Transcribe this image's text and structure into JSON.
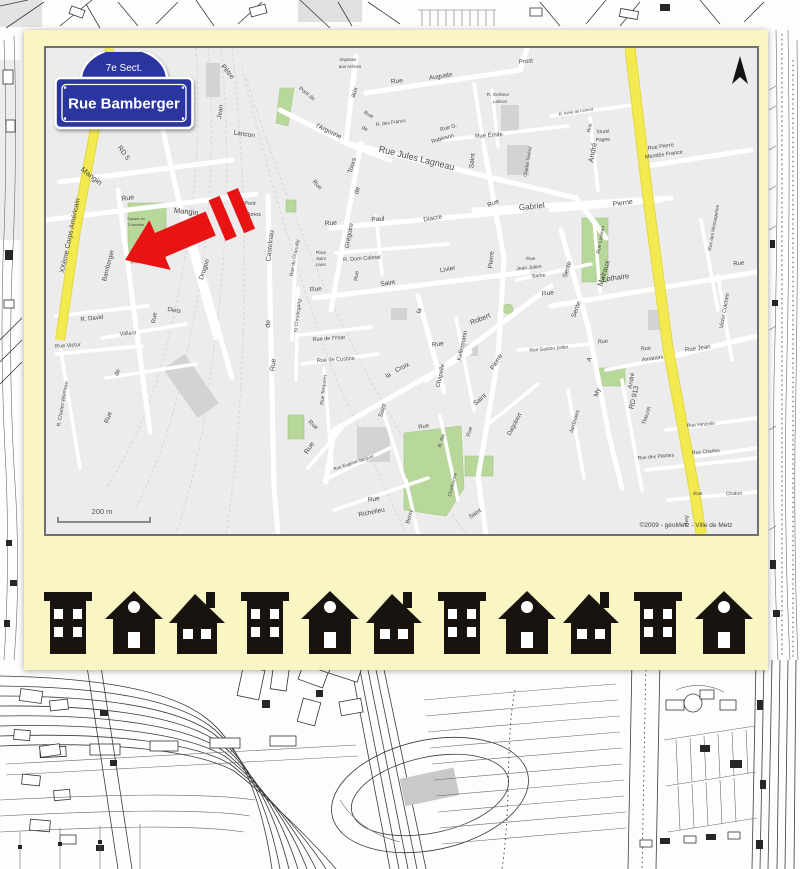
{
  "postcard": {
    "sign": {
      "section": "7e Sect.",
      "street": "Rue Bamberger"
    },
    "map": {
      "scale_label": "200 m",
      "attribution": "©2009 - géoMetz - Ville de Metz",
      "labels": [
        [
          "Pètre",
          180,
          25,
          50,
          7
        ],
        [
          "Jean",
          176,
          64,
          -82,
          6.5
        ],
        [
          "Lancon",
          198,
          88,
          8,
          6.5
        ],
        [
          "Mangin",
          44,
          130,
          38,
          7.5
        ],
        [
          "RD 5",
          76,
          106,
          55,
          7
        ],
        [
          "XXème Corps Américain",
          26,
          188,
          -78,
          7
        ],
        [
          "Rue",
          82,
          152,
          -8,
          7
        ],
        [
          "Mangin",
          140,
          166,
          6,
          7.5
        ],
        [
          "Pont",
          204,
          157,
          0,
          5.5
        ],
        [
          "Amos",
          208,
          168,
          0,
          5.5
        ],
        [
          "Drogon",
          110,
          52,
          -80,
          6.5
        ],
        [
          "Drogon",
          160,
          222,
          -72,
          6.5
        ],
        [
          "Bamberger",
          64,
          218,
          -75,
          6.5
        ],
        [
          "Aubrée",
          94,
          213,
          -15,
          5
        ],
        [
          "R. David",
          46,
          272,
          -6,
          6
        ],
        [
          "Dietz",
          128,
          264,
          10,
          6
        ],
        [
          "Vallant",
          82,
          287,
          -5,
          5.5
        ],
        [
          "Rue",
          110,
          270,
          -82,
          6
        ],
        [
          "Rue Victor",
          22,
          299,
          -4,
          5.5
        ],
        [
          "R. Charles Woirhaye",
          18,
          356,
          -80,
          5
        ],
        [
          "de",
          73,
          325,
          -70,
          6
        ],
        [
          "Rue",
          64,
          370,
          -70,
          6.5
        ],
        [
          "Castelnau",
          226,
          198,
          -84,
          7
        ],
        [
          "de",
          224,
          276,
          -84,
          7
        ],
        [
          "Rue",
          229,
          317,
          -84,
          7
        ],
        [
          "Pont de",
          260,
          47,
          38,
          5.5
        ],
        [
          "l'Argonne",
          282,
          85,
          26,
          6.5
        ],
        [
          "aux",
          310,
          45,
          -72,
          6.5
        ],
        [
          "Impasse",
          302,
          13,
          0,
          4.5
        ],
        [
          "aux Arènes",
          304,
          20,
          0,
          4.5
        ],
        [
          "Rue",
          351,
          35,
          -6,
          6.5
        ],
        [
          "Auguste",
          395,
          30,
          -9,
          6.5
        ],
        [
          "Prost",
          480,
          15,
          -5,
          6
        ],
        [
          "R. Gerbeur",
          452,
          48,
          0,
          4.5
        ],
        [
          "Lebrun",
          454,
          55,
          0,
          4.5
        ],
        [
          "Rue G.",
          403,
          81,
          -16,
          5.5
        ],
        [
          "Robinson",
          397,
          92,
          -16,
          5.5
        ],
        [
          "Rue Émile",
          443,
          89,
          -4,
          6
        ],
        [
          "R. des Francs",
          345,
          76,
          -8,
          4.8
        ],
        [
          "Rue",
          322,
          68,
          28,
          5.5
        ],
        [
          "de",
          318,
          82,
          28,
          5.5
        ],
        [
          "Rue Jules Lagneau",
          370,
          113,
          14,
          9
        ],
        [
          "Saint",
          428,
          113,
          -84,
          6.5
        ],
        [
          "Rue",
          448,
          157,
          -24,
          6.5
        ],
        [
          "Gabriel",
          486,
          161,
          -5,
          8
        ],
        [
          "Charles Sadoul",
          483,
          114,
          -80,
          4.5
        ],
        [
          "Tours",
          308,
          118,
          -73,
          6.5
        ],
        [
          "de",
          313,
          143,
          -73,
          6.5
        ],
        [
          "Grégoire",
          305,
          188,
          -80,
          6.5
        ],
        [
          "Rue",
          285,
          177,
          -4,
          6.5
        ],
        [
          "Paul",
          332,
          173,
          -4,
          6.5
        ],
        [
          "Diacre",
          387,
          172,
          -10,
          6.5
        ],
        [
          "Pierre",
          447,
          212,
          -84,
          6.5
        ],
        [
          "Rue",
          270,
          138,
          45,
          6
        ],
        [
          "Rue du Graouilly",
          250,
          210,
          -80,
          5
        ],
        [
          "Place",
          275,
          206,
          0,
          4.2
        ],
        [
          "Saint",
          275,
          212,
          0,
          4.2
        ],
        [
          "Livier",
          275,
          218,
          0,
          4.2
        ],
        [
          "R. Dom Calmat",
          316,
          212,
          -4,
          5.5
        ],
        [
          "Rue",
          312,
          228,
          -84,
          5.5
        ],
        [
          "Rue",
          270,
          243,
          -5,
          6.5
        ],
        [
          "Saint",
          342,
          237,
          -8,
          6.5
        ],
        [
          "Livier",
          402,
          223,
          -10,
          6.5
        ],
        [
          "St Chrodegang",
          253,
          268,
          -84,
          5
        ],
        [
          "Rue de l'Ysar",
          283,
          292,
          -4,
          5.5
        ],
        [
          "Rue de Custine",
          290,
          313,
          -4,
          5.5
        ],
        [
          "Rue Terquem",
          279,
          342,
          -84,
          5
        ],
        [
          "la",
          375,
          263,
          -78,
          6.5
        ],
        [
          "Rue",
          392,
          298,
          -8,
          6.5
        ],
        [
          "Chapelle",
          396,
          328,
          -78,
          6
        ],
        [
          "la",
          343,
          329,
          -26,
          6.5
        ],
        [
          "Croix",
          357,
          321,
          -26,
          6.5
        ],
        [
          "Kellermann",
          418,
          298,
          -78,
          6
        ],
        [
          "Robert",
          435,
          273,
          -22,
          7
        ],
        [
          "Pierre",
          452,
          315,
          -58,
          6.5
        ],
        [
          "Saint",
          435,
          353,
          -40,
          6.5
        ],
        [
          "Rue",
          485,
          212,
          -5,
          5
        ],
        [
          "Jean Julien",
          483,
          221,
          -5,
          5
        ],
        [
          "Barbe",
          493,
          229,
          -5,
          5
        ],
        [
          "Sente",
          523,
          222,
          -73,
          6.5
        ],
        [
          "Sente",
          532,
          262,
          -70,
          6.5
        ],
        [
          "A",
          545,
          312,
          -68,
          6.5
        ],
        [
          "My",
          553,
          345,
          -73,
          6.5
        ],
        [
          "Lothaire",
          570,
          232,
          -8,
          7.5
        ],
        [
          "Rue",
          502,
          247,
          -5,
          6.5
        ],
        [
          "Malraux",
          560,
          226,
          -73,
          7.5
        ],
        [
          "RD 913",
          590,
          350,
          -77,
          7
        ],
        [
          "André",
          549,
          105,
          -80,
          7.5
        ],
        [
          "Victor Colchen",
          680,
          263,
          -80,
          5.5
        ],
        [
          "Rue",
          693,
          217,
          -5,
          6
        ],
        [
          "Rue Jean",
          652,
          302,
          -8,
          6
        ],
        [
          "Rue",
          600,
          302,
          -5,
          5.5
        ],
        [
          "Amataire",
          607,
          312,
          -8,
          5.5
        ],
        [
          "André",
          587,
          333,
          -80,
          6
        ],
        [
          "Theurin",
          602,
          368,
          -73,
          5.5
        ],
        [
          "Rue Hinzelin",
          655,
          378,
          -5,
          5
        ],
        [
          "Rue Gaston Zeller",
          503,
          302,
          -5,
          4.8
        ],
        [
          "Jardiniers",
          530,
          374,
          -73,
          5.5
        ],
        [
          "Rue",
          557,
          295,
          -5,
          5.5
        ],
        [
          "Rue des Plantes",
          610,
          410,
          -5,
          5
        ],
        [
          "Rue Charles",
          660,
          405,
          -5,
          5
        ],
        [
          "Rue",
          652,
          447,
          -3,
          5
        ],
        [
          "Chabot",
          688,
          447,
          -3,
          5
        ],
        [
          "Avril",
          642,
          473,
          -80,
          5.5
        ],
        [
          "Rue Pierre",
          615,
          100,
          -8,
          5.5
        ],
        [
          "Mendès France",
          618,
          108,
          -8,
          5.5
        ],
        [
          "Sturel",
          557,
          85,
          -3,
          5
        ],
        [
          "Pagne",
          557,
          93,
          -3,
          5
        ],
        [
          "R. Aimé de Lemud",
          530,
          65,
          -9,
          4.2
        ],
        [
          "Rue",
          545,
          80,
          -80,
          5
        ],
        [
          "Pierne",
          577,
          157,
          -8,
          7
        ],
        [
          "Rue des Messageries",
          669,
          180,
          -80,
          4.8
        ],
        [
          "Rue Loiseau",
          556,
          192,
          -80,
          5
        ],
        [
          "Square du",
          90,
          172,
          0,
          3.8
        ],
        [
          "Chanoine",
          90,
          178,
          0,
          3.8
        ],
        [
          "R. Ste",
          397,
          393,
          -73,
          5
        ],
        [
          "Chrétienne",
          408,
          437,
          -76,
          5
        ],
        [
          "Saint",
          430,
          467,
          -34,
          6
        ],
        [
          "Dagobert",
          470,
          377,
          -62,
          6
        ],
        [
          "Rue",
          378,
          380,
          -10,
          6
        ],
        [
          "Rue",
          425,
          384,
          -73,
          5.5
        ],
        [
          "Saint",
          338,
          363,
          -73,
          6
        ],
        [
          "Rue",
          266,
          378,
          42,
          6
        ],
        [
          "Rue Eugène Jacquot",
          308,
          416,
          -18,
          4.5
        ],
        [
          "Rue",
          328,
          453,
          -8,
          6.5
        ],
        [
          "Richelieu",
          326,
          466,
          -12,
          6.5
        ],
        [
          "Berny",
          365,
          469,
          -73,
          5.5
        ],
        [
          "Rue",
          265,
          401,
          -58,
          7
        ]
      ]
    },
    "houses": {
      "types": [
        "building",
        "gable",
        "chimney",
        "building",
        "gable",
        "chimney",
        "building",
        "gable",
        "chimney",
        "building",
        "gable"
      ]
    }
  }
}
